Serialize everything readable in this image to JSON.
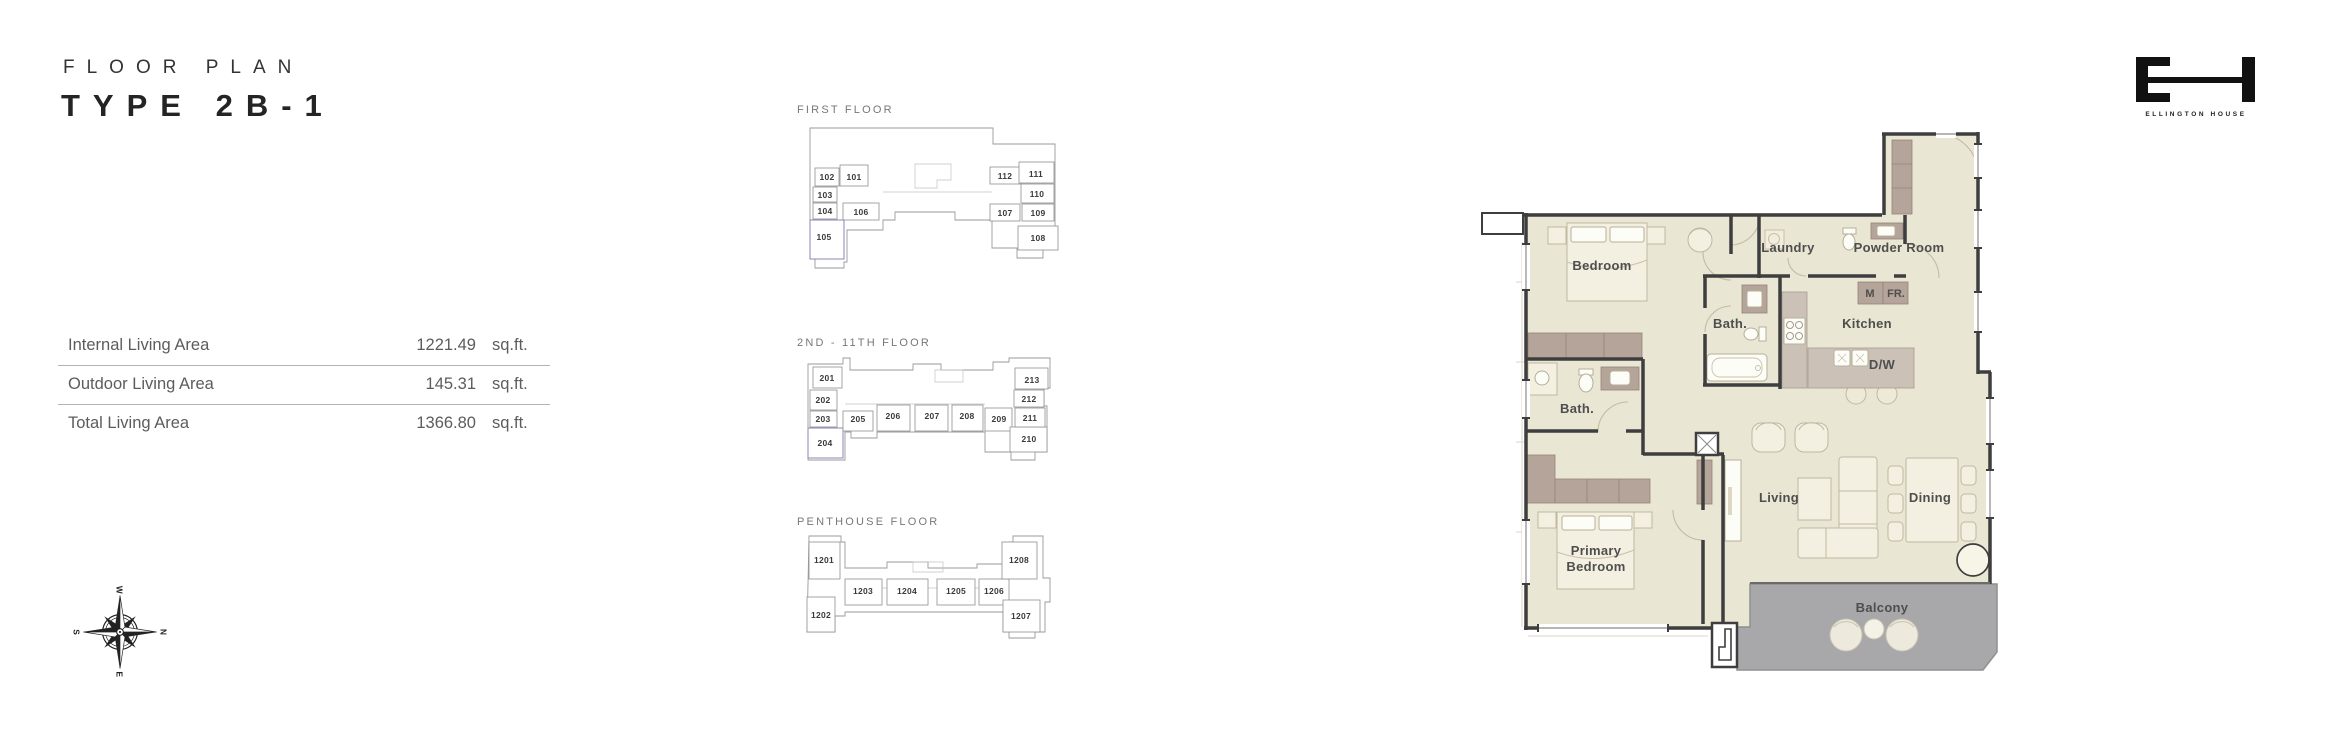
{
  "header": {
    "eyebrow": "FLOOR PLAN",
    "title": "TYPE 2B-1"
  },
  "area_table": {
    "rows": [
      {
        "label": "Internal Living Area",
        "value": "1221.49",
        "unit": "sq.ft."
      },
      {
        "label": "Outdoor Living Area",
        "value": "145.31",
        "unit": "sq.ft."
      },
      {
        "label": "Total Living Area",
        "value": "1366.80",
        "unit": "sq.ft."
      }
    ]
  },
  "key_plans": {
    "first": {
      "title": "FIRST FLOOR",
      "highlighted_unit": "105",
      "units": {
        "u101": "101",
        "u102": "102",
        "u103": "103",
        "u104": "104",
        "u105": "105",
        "u106": "106",
        "u107": "107",
        "u108": "108",
        "u109": "109",
        "u110": "110",
        "u111": "111",
        "u112": "112"
      }
    },
    "second": {
      "title": "2ND - 11TH FLOOR",
      "highlighted_unit": "204",
      "units": {
        "u201": "201",
        "u202": "202",
        "u203": "203",
        "u204": "204",
        "u205": "205",
        "u206": "206",
        "u207": "207",
        "u208": "208",
        "u209": "209",
        "u210": "210",
        "u211": "211",
        "u212": "212",
        "u213": "213"
      }
    },
    "penthouse": {
      "title": "PENTHOUSE FLOOR",
      "highlighted_unit": "",
      "units": {
        "u1201": "1201",
        "u1202": "1202",
        "u1203": "1203",
        "u1204": "1204",
        "u1205": "1205",
        "u1206": "1206",
        "u1207": "1207",
        "u1208": "1208"
      }
    }
  },
  "floor_plan": {
    "labels": {
      "bedroom": "Bedroom",
      "laundry": "Laundry",
      "powder_room": "Powder Room",
      "kitchen": "Kitchen",
      "microwave": "M",
      "fridge": "FR.",
      "dishwasher": "D/W",
      "bath_center": "Bath.",
      "bath_left": "Bath.",
      "living": "Living",
      "dining": "Dining",
      "primary_line1": "Primary",
      "primary_line2": "Bedroom",
      "balcony": "Balcony"
    }
  },
  "compass": {
    "north": "N",
    "south": "S",
    "east": "E",
    "west": "W"
  },
  "logo": {
    "name": "ELLINGTON HOUSE"
  },
  "colors": {
    "floor": "#eae6d4",
    "wall": "#3e3e3e",
    "cabinet": "#b5a49a",
    "counter": "#ccc1b7",
    "balcony": "#a8a8ab",
    "highlight_pink": "#e8c0c8",
    "highlight_blue": "#a9b3de"
  }
}
